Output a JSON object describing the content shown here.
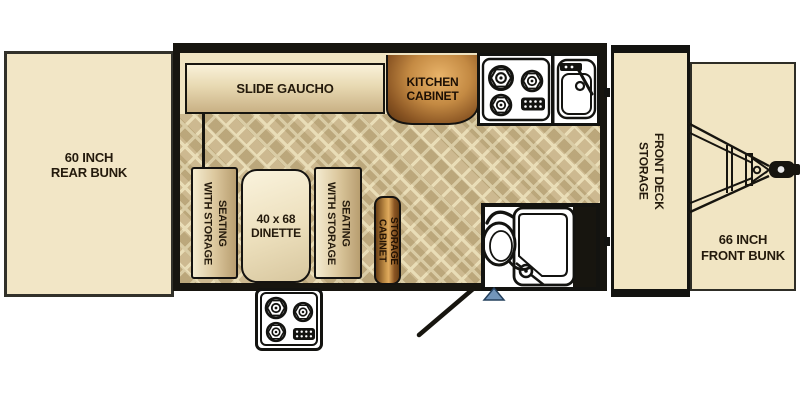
{
  "floorplan": {
    "rear_bunk_label": "60 INCH\nREAR BUNK",
    "slide_gaucho_label": "SLIDE GAUCHO",
    "kitchen_cabinet_label": "KITCHEN\nCABINET",
    "seat_left_label": "SEATING\nWITH STORAGE",
    "dinette_label": "40 x 68\nDINETTE",
    "seat_right_label": "SEATING\nWITH STORAGE",
    "storage_cabinet_label": "STORAGE\nCABINET",
    "front_deck_label": "FRONT DECK\nSTORAGE",
    "front_bunk_label": "66 INCH\nFRONT BUNK"
  },
  "colors": {
    "cream": "#f1e5c3",
    "floor_tan": "#c7b183",
    "floor_lattice": "#e7d9af",
    "copper_light": "#e9b46a",
    "copper_dark": "#5c3512",
    "wall_black": "#17150f",
    "entry_step_blue": "#7295ba",
    "text_dark": "#241a0c"
  }
}
